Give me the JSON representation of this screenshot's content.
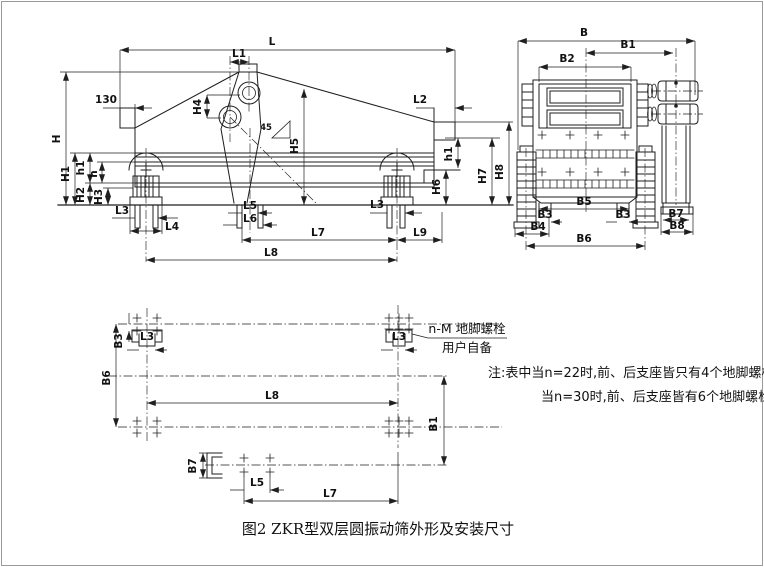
{
  "figure": {
    "caption": "图2 ZKR型双层圆振动筛外形及安装尺寸",
    "note": {
      "line1": "注:表中当n=22时,前、后支座皆只有4个地脚螺栓、",
      "line2": "当n=30时,前、后支座皆有6个地脚螺栓"
    },
    "callout": {
      "line1": "n-M 地脚螺栓",
      "line2": "用户自备"
    }
  },
  "dims": {
    "L": "L",
    "L1": "L1",
    "L2": "L2",
    "L3": "L3",
    "L4": "L4",
    "L5": "L5",
    "L6": "L6",
    "L7": "L7",
    "L8": "L8",
    "L9": "L9",
    "H": "H",
    "H1": "H1",
    "H2": "H2",
    "H3": "H3",
    "H4": "H4",
    "H5": "H5",
    "H6": "H6",
    "H7": "H7",
    "H8": "H8",
    "h": "h",
    "h1": "h1",
    "B": "B",
    "B1": "B1",
    "B2": "B2",
    "B3": "B3",
    "B4": "B4",
    "B5": "B5",
    "B6": "B6",
    "B7": "B7",
    "B8": "B8",
    "offset": "130",
    "angle": "45"
  },
  "colors": {
    "line": "#1f1f1f",
    "background": "#ffffff"
  }
}
